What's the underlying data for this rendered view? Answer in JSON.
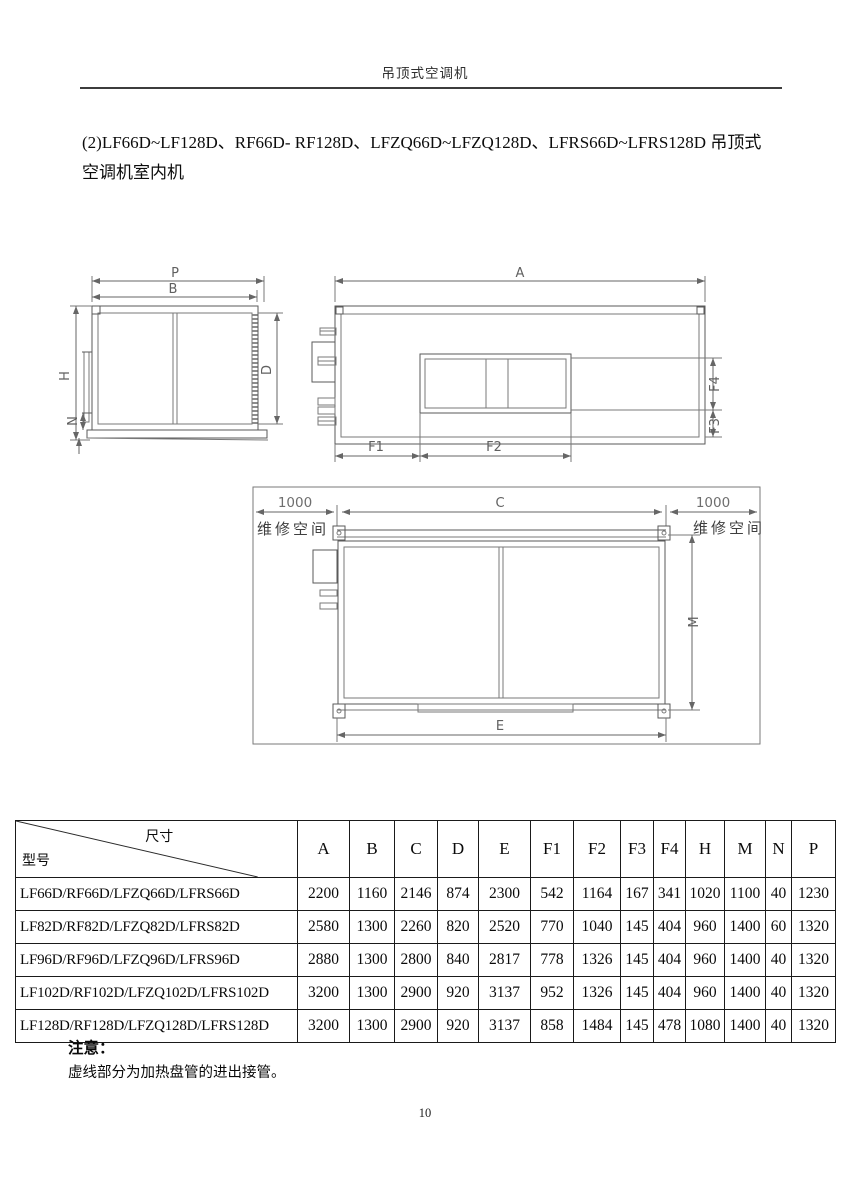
{
  "header": {
    "title": "吊顶式空调机"
  },
  "intro": {
    "line1": "(2)LF66D~LF128D、RF66D- RF128D、LFZQ66D~LFZQ128D、LFRS66D~LFRS128D 吊顶式",
    "line2": "空调机室内机"
  },
  "drawings": {
    "side_view": {
      "dim_p": "P",
      "dim_b": "B",
      "dim_h": "H",
      "dim_d": "D",
      "dim_n": "N"
    },
    "front_view": {
      "dim_a": "A",
      "dim_f1": "F1",
      "dim_f2": "F2",
      "dim_f3": "F3",
      "dim_f4": "F4"
    },
    "plan_view": {
      "dim_left_clearance": "1000",
      "dim_c": "C",
      "dim_right_clearance": "1000",
      "service_space_left": "维修空间",
      "service_space_right": "维修空间",
      "dim_m": "M",
      "dim_e": "E"
    }
  },
  "table": {
    "corner_top": "尺寸",
    "corner_bottom": "型号",
    "columns": [
      "A",
      "B",
      "C",
      "D",
      "E",
      "F1",
      "F2",
      "F3",
      "F4",
      "H",
      "M",
      "N",
      "P"
    ],
    "rows": [
      {
        "model": "LF66D/RF66D/LFZQ66D/LFRS66D",
        "values": [
          "2200",
          "1160",
          "2146",
          "874",
          "2300",
          "542",
          "1164",
          "167",
          "341",
          "1020",
          "1100",
          "40",
          "1230"
        ]
      },
      {
        "model": "LF82D/RF82D/LFZQ82D/LFRS82D",
        "values": [
          "2580",
          "1300",
          "2260",
          "820",
          "2520",
          "770",
          "1040",
          "145",
          "404",
          "960",
          "1400",
          "60",
          "1320"
        ]
      },
      {
        "model": "LF96D/RF96D/LFZQ96D/LFRS96D",
        "values": [
          "2880",
          "1300",
          "2800",
          "840",
          "2817",
          "778",
          "1326",
          "145",
          "404",
          "960",
          "1400",
          "40",
          "1320"
        ]
      },
      {
        "model": "LF102D/RF102D/LFZQ102D/LFRS102D",
        "values": [
          "3200",
          "1300",
          "2900",
          "920",
          "3137",
          "952",
          "1326",
          "145",
          "404",
          "960",
          "1400",
          "40",
          "1320"
        ]
      },
      {
        "model": "LF128D/RF128D/LFZQ128D/LFRS128D",
        "values": [
          "3200",
          "1300",
          "2900",
          "920",
          "3137",
          "858",
          "1484",
          "145",
          "478",
          "1080",
          "1400",
          "40",
          "1320"
        ]
      }
    ]
  },
  "note": {
    "title": "注意：",
    "body": "虚线部分为加热盘管的进出接管。"
  },
  "footer": {
    "page_number": "10"
  }
}
